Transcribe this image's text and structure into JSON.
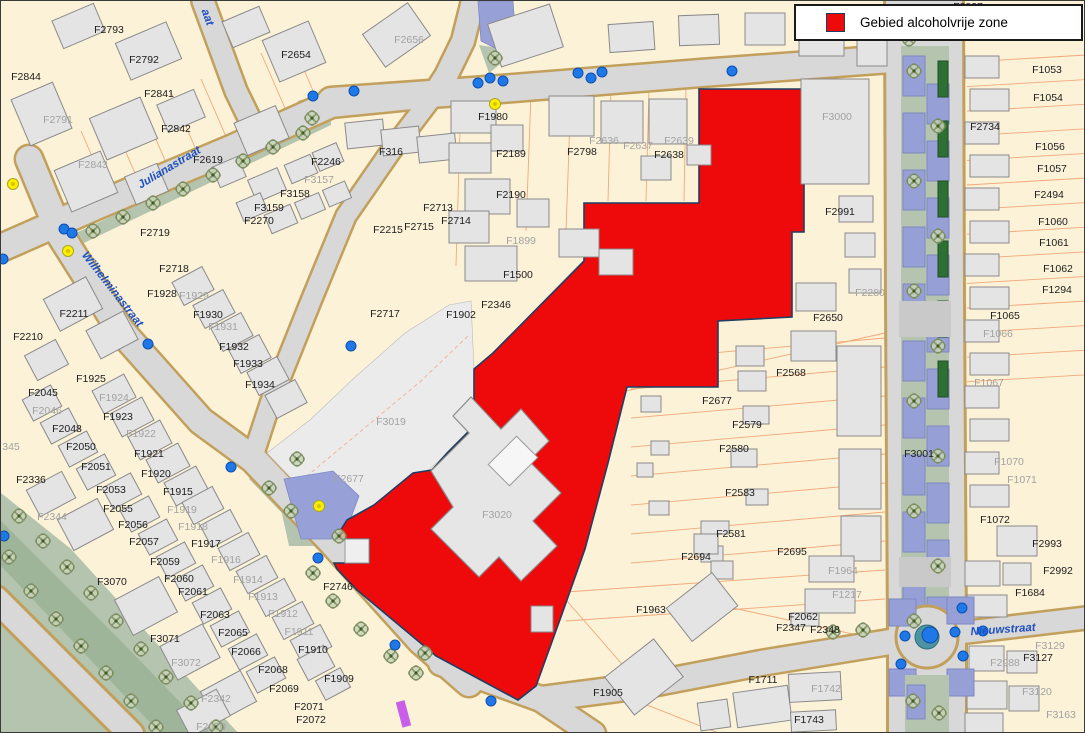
{
  "legend": {
    "label": "Gebied alcoholvrije zone",
    "swatch_color": "#ee0a0a"
  },
  "map": {
    "colors": {
      "parcel_fill": "#fcf2d8",
      "road_fill": "#d8d8d8",
      "road_edge": "#c2a05c",
      "building_fill": "#e4e4e4",
      "zone_fill": "#ee0a0a",
      "zone_border": "#1d3f63",
      "water_fill": "#98a0d8",
      "green_fill": "#b5c4ae",
      "marker_blue": "#1e78e8",
      "marker_yellow": "#ffe800",
      "label_black": "#1c1c1c",
      "label_gray": "#a2a2a2",
      "street_name_blue": "#1d50c0"
    },
    "street_names": [
      {
        "text": "Julianastraat",
        "x": 168,
        "y": 166,
        "rot": -31
      },
      {
        "text": "Wilhelminastraat",
        "x": 112,
        "y": 288,
        "rot": 52
      },
      {
        "text": "Nieuwstraat",
        "x": 1002,
        "y": 628,
        "rot": -4
      },
      {
        "text": "aat",
        "x": 207,
        "y": 16,
        "rot": 70
      }
    ],
    "parcel_labels": [
      {
        "t": "F2793",
        "x": 108,
        "y": 28,
        "c": "k"
      },
      {
        "t": "F2792",
        "x": 143,
        "y": 58,
        "c": "k"
      },
      {
        "t": "F2844",
        "x": 25,
        "y": 75,
        "c": "k"
      },
      {
        "t": "F2841",
        "x": 158,
        "y": 92,
        "c": "k"
      },
      {
        "t": "F2791",
        "x": 57,
        "y": 118,
        "c": "g"
      },
      {
        "t": "F2842",
        "x": 175,
        "y": 127,
        "c": "k"
      },
      {
        "t": "F2843",
        "x": 92,
        "y": 163,
        "c": "g"
      },
      {
        "t": "F2654",
        "x": 295,
        "y": 53,
        "c": "k"
      },
      {
        "t": "F2656",
        "x": 408,
        "y": 38,
        "c": "g"
      },
      {
        "t": "F2619",
        "x": 207,
        "y": 158,
        "c": "k"
      },
      {
        "t": "F2246",
        "x": 325,
        "y": 160,
        "c": "k"
      },
      {
        "t": "F3157",
        "x": 318,
        "y": 178,
        "c": "g"
      },
      {
        "t": "F3158",
        "x": 294,
        "y": 192,
        "c": "k"
      },
      {
        "t": "F3159",
        "x": 268,
        "y": 206,
        "c": "k"
      },
      {
        "t": "F2270",
        "x": 258,
        "y": 219,
        "c": "k"
      },
      {
        "t": "F2719",
        "x": 154,
        "y": 231,
        "c": "k"
      },
      {
        "t": "F316",
        "x": 390,
        "y": 150,
        "c": "k"
      },
      {
        "t": "F2718",
        "x": 173,
        "y": 267,
        "c": "k"
      },
      {
        "t": "F1928",
        "x": 161,
        "y": 292,
        "c": "k"
      },
      {
        "t": "F1929",
        "x": 193,
        "y": 294,
        "c": "g"
      },
      {
        "t": "F2211",
        "x": 73,
        "y": 312,
        "c": "k"
      },
      {
        "t": "F2210",
        "x": 27,
        "y": 335,
        "c": "k"
      },
      {
        "t": "F1930",
        "x": 207,
        "y": 313,
        "c": "k"
      },
      {
        "t": "F1931",
        "x": 222,
        "y": 325,
        "c": "g"
      },
      {
        "t": "F1932",
        "x": 233,
        "y": 345,
        "c": "k"
      },
      {
        "t": "F1933",
        "x": 247,
        "y": 362,
        "c": "k"
      },
      {
        "t": "F1934",
        "x": 259,
        "y": 383,
        "c": "k"
      },
      {
        "t": "F1925",
        "x": 90,
        "y": 377,
        "c": "k"
      },
      {
        "t": "F2045",
        "x": 42,
        "y": 391,
        "c": "k"
      },
      {
        "t": "F1924",
        "x": 113,
        "y": 396,
        "c": "g"
      },
      {
        "t": "F2046",
        "x": 46,
        "y": 409,
        "c": "g"
      },
      {
        "t": "F1923",
        "x": 117,
        "y": 415,
        "c": "k"
      },
      {
        "t": "F2048",
        "x": 66,
        "y": 427,
        "c": "k"
      },
      {
        "t": "F1922",
        "x": 140,
        "y": 432,
        "c": "g"
      },
      {
        "t": "F2050",
        "x": 80,
        "y": 445,
        "c": "k"
      },
      {
        "t": "F1921",
        "x": 148,
        "y": 452,
        "c": "k"
      },
      {
        "t": "F2051",
        "x": 95,
        "y": 465,
        "c": "k"
      },
      {
        "t": "F1920",
        "x": 155,
        "y": 472,
        "c": "k"
      },
      {
        "t": "F2336",
        "x": 30,
        "y": 478,
        "c": "k"
      },
      {
        "t": "345",
        "x": 10,
        "y": 445,
        "c": "g"
      },
      {
        "t": "F2344",
        "x": 51,
        "y": 515,
        "c": "g"
      },
      {
        "t": "F2053",
        "x": 110,
        "y": 488,
        "c": "k"
      },
      {
        "t": "F1915",
        "x": 177,
        "y": 490,
        "c": "k"
      },
      {
        "t": "F2055",
        "x": 117,
        "y": 507,
        "c": "k"
      },
      {
        "t": "F1919",
        "x": 181,
        "y": 508,
        "c": "g"
      },
      {
        "t": "F2056",
        "x": 132,
        "y": 523,
        "c": "k"
      },
      {
        "t": "F1918",
        "x": 192,
        "y": 525,
        "c": "g"
      },
      {
        "t": "F2057",
        "x": 143,
        "y": 540,
        "c": "k"
      },
      {
        "t": "F1917",
        "x": 205,
        "y": 542,
        "c": "k"
      },
      {
        "t": "F2059",
        "x": 164,
        "y": 560,
        "c": "k"
      },
      {
        "t": "F1916",
        "x": 225,
        "y": 558,
        "c": "g"
      },
      {
        "t": "F2060",
        "x": 178,
        "y": 577,
        "c": "k"
      },
      {
        "t": "F3070",
        "x": 111,
        "y": 580,
        "c": "k"
      },
      {
        "t": "F1914",
        "x": 247,
        "y": 578,
        "c": "g"
      },
      {
        "t": "F2061",
        "x": 192,
        "y": 590,
        "c": "k"
      },
      {
        "t": "F1913",
        "x": 262,
        "y": 595,
        "c": "g"
      },
      {
        "t": "F2063",
        "x": 214,
        "y": 613,
        "c": "k"
      },
      {
        "t": "F1912",
        "x": 282,
        "y": 612,
        "c": "g"
      },
      {
        "t": "F2065",
        "x": 232,
        "y": 631,
        "c": "k"
      },
      {
        "t": "F1911",
        "x": 298,
        "y": 630,
        "c": "g"
      },
      {
        "t": "F3071",
        "x": 164,
        "y": 637,
        "c": "k"
      },
      {
        "t": "F2066",
        "x": 245,
        "y": 650,
        "c": "k"
      },
      {
        "t": "F1910",
        "x": 312,
        "y": 648,
        "c": "k"
      },
      {
        "t": "F3072",
        "x": 185,
        "y": 661,
        "c": "g"
      },
      {
        "t": "F2068",
        "x": 272,
        "y": 668,
        "c": "k"
      },
      {
        "t": "F1909",
        "x": 338,
        "y": 677,
        "c": "k"
      },
      {
        "t": "F2069",
        "x": 283,
        "y": 687,
        "c": "k"
      },
      {
        "t": "F2342",
        "x": 215,
        "y": 697,
        "c": "g"
      },
      {
        "t": "F2071",
        "x": 308,
        "y": 705,
        "c": "k"
      },
      {
        "t": "F2072",
        "x": 310,
        "y": 718,
        "c": "k"
      },
      {
        "t": "F2070",
        "x": 210,
        "y": 725,
        "c": "g"
      },
      {
        "t": "F2713",
        "x": 437,
        "y": 206,
        "c": "k"
      },
      {
        "t": "F2714",
        "x": 455,
        "y": 219,
        "c": "k"
      },
      {
        "t": "F2215",
        "x": 387,
        "y": 228,
        "c": "k"
      },
      {
        "t": "F2715",
        "x": 418,
        "y": 225,
        "c": "k"
      },
      {
        "t": "F2717",
        "x": 384,
        "y": 312,
        "c": "k"
      },
      {
        "t": "F1980",
        "x": 492,
        "y": 115,
        "c": "k"
      },
      {
        "t": "F2189",
        "x": 510,
        "y": 152,
        "c": "k"
      },
      {
        "t": "F2190",
        "x": 510,
        "y": 193,
        "c": "k"
      },
      {
        "t": "F1899",
        "x": 520,
        "y": 239,
        "c": "g"
      },
      {
        "t": "F2798",
        "x": 581,
        "y": 150,
        "c": "k"
      },
      {
        "t": "F2636",
        "x": 603,
        "y": 139,
        "c": "g"
      },
      {
        "t": "F2637",
        "x": 637,
        "y": 144,
        "c": "g"
      },
      {
        "t": "F2638",
        "x": 668,
        "y": 153,
        "c": "k"
      },
      {
        "t": "F2639",
        "x": 678,
        "y": 139,
        "c": "g"
      },
      {
        "t": "F1500",
        "x": 517,
        "y": 273,
        "c": "k"
      },
      {
        "t": "F2346",
        "x": 495,
        "y": 303,
        "c": "k"
      },
      {
        "t": "F1902",
        "x": 460,
        "y": 313,
        "c": "k"
      },
      {
        "t": "F3019",
        "x": 390,
        "y": 420,
        "c": "g"
      },
      {
        "t": "F2677",
        "x": 348,
        "y": 477,
        "c": "g"
      },
      {
        "t": "F3020",
        "x": 496,
        "y": 513,
        "c": "g"
      },
      {
        "t": "F2746",
        "x": 337,
        "y": 585,
        "c": "k"
      },
      {
        "t": "F2837",
        "x": 967,
        "y": 5,
        "c": "k"
      },
      {
        "t": "F3000",
        "x": 836,
        "y": 115,
        "c": "g"
      },
      {
        "t": "F2991",
        "x": 839,
        "y": 210,
        "c": "k"
      },
      {
        "t": "F2280",
        "x": 869,
        "y": 291,
        "c": "g"
      },
      {
        "t": "F2650",
        "x": 827,
        "y": 316,
        "c": "k"
      },
      {
        "t": "F2568",
        "x": 790,
        "y": 371,
        "c": "k"
      },
      {
        "t": "F2677",
        "x": 716,
        "y": 399,
        "c": "k"
      },
      {
        "t": "F2579",
        "x": 746,
        "y": 423,
        "c": "k"
      },
      {
        "t": "F2580",
        "x": 733,
        "y": 447,
        "c": "k"
      },
      {
        "t": "F2583",
        "x": 739,
        "y": 491,
        "c": "k"
      },
      {
        "t": "F2581",
        "x": 730,
        "y": 532,
        "c": "k"
      },
      {
        "t": "F2695",
        "x": 791,
        "y": 550,
        "c": "k"
      },
      {
        "t": "F2694",
        "x": 695,
        "y": 555,
        "c": "k"
      },
      {
        "t": "F1964",
        "x": 842,
        "y": 569,
        "c": "g"
      },
      {
        "t": "F1963",
        "x": 650,
        "y": 608,
        "c": "k"
      },
      {
        "t": "F1217",
        "x": 846,
        "y": 593,
        "c": "g"
      },
      {
        "t": "F2062",
        "x": 802,
        "y": 615,
        "c": "k"
      },
      {
        "t": "F2347",
        "x": 790,
        "y": 626,
        "c": "k"
      },
      {
        "t": "F2348",
        "x": 824,
        "y": 628,
        "c": "k"
      },
      {
        "t": "F1905",
        "x": 607,
        "y": 691,
        "c": "k"
      },
      {
        "t": "F1711",
        "x": 762,
        "y": 678,
        "c": "k"
      },
      {
        "t": "F1742",
        "x": 825,
        "y": 687,
        "c": "g"
      },
      {
        "t": "F1743",
        "x": 808,
        "y": 718,
        "c": "k"
      },
      {
        "t": "F1053",
        "x": 1046,
        "y": 68,
        "c": "k"
      },
      {
        "t": "F1054",
        "x": 1047,
        "y": 96,
        "c": "k"
      },
      {
        "t": "F2734",
        "x": 984,
        "y": 125,
        "c": "k"
      },
      {
        "t": "F1056",
        "x": 1049,
        "y": 145,
        "c": "k"
      },
      {
        "t": "F1057",
        "x": 1051,
        "y": 167,
        "c": "k"
      },
      {
        "t": "F2494",
        "x": 1048,
        "y": 193,
        "c": "k"
      },
      {
        "t": "F1060",
        "x": 1052,
        "y": 220,
        "c": "k"
      },
      {
        "t": "F1061",
        "x": 1053,
        "y": 241,
        "c": "k"
      },
      {
        "t": "F1062",
        "x": 1057,
        "y": 267,
        "c": "k"
      },
      {
        "t": "F1294",
        "x": 1056,
        "y": 288,
        "c": "k"
      },
      {
        "t": "F1065",
        "x": 1004,
        "y": 314,
        "c": "k"
      },
      {
        "t": "F1066",
        "x": 997,
        "y": 332,
        "c": "g"
      },
      {
        "t": "F1067",
        "x": 988,
        "y": 381,
        "c": "g"
      },
      {
        "t": "F3001",
        "x": 918,
        "y": 452,
        "c": "k"
      },
      {
        "t": "F1070",
        "x": 1008,
        "y": 460,
        "c": "g"
      },
      {
        "t": "F1071",
        "x": 1021,
        "y": 478,
        "c": "g"
      },
      {
        "t": "F1072",
        "x": 994,
        "y": 518,
        "c": "k"
      },
      {
        "t": "F2993",
        "x": 1046,
        "y": 542,
        "c": "k"
      },
      {
        "t": "F2992",
        "x": 1057,
        "y": 569,
        "c": "k"
      },
      {
        "t": "F1684",
        "x": 1029,
        "y": 591,
        "c": "k"
      },
      {
        "t": "F3129",
        "x": 1049,
        "y": 644,
        "c": "g"
      },
      {
        "t": "F2988",
        "x": 1004,
        "y": 661,
        "c": "g"
      },
      {
        "t": "F3127",
        "x": 1037,
        "y": 656,
        "c": "k"
      },
      {
        "t": "F3120",
        "x": 1036,
        "y": 690,
        "c": "g"
      },
      {
        "t": "F3163",
        "x": 1060,
        "y": 713,
        "c": "g"
      }
    ]
  }
}
